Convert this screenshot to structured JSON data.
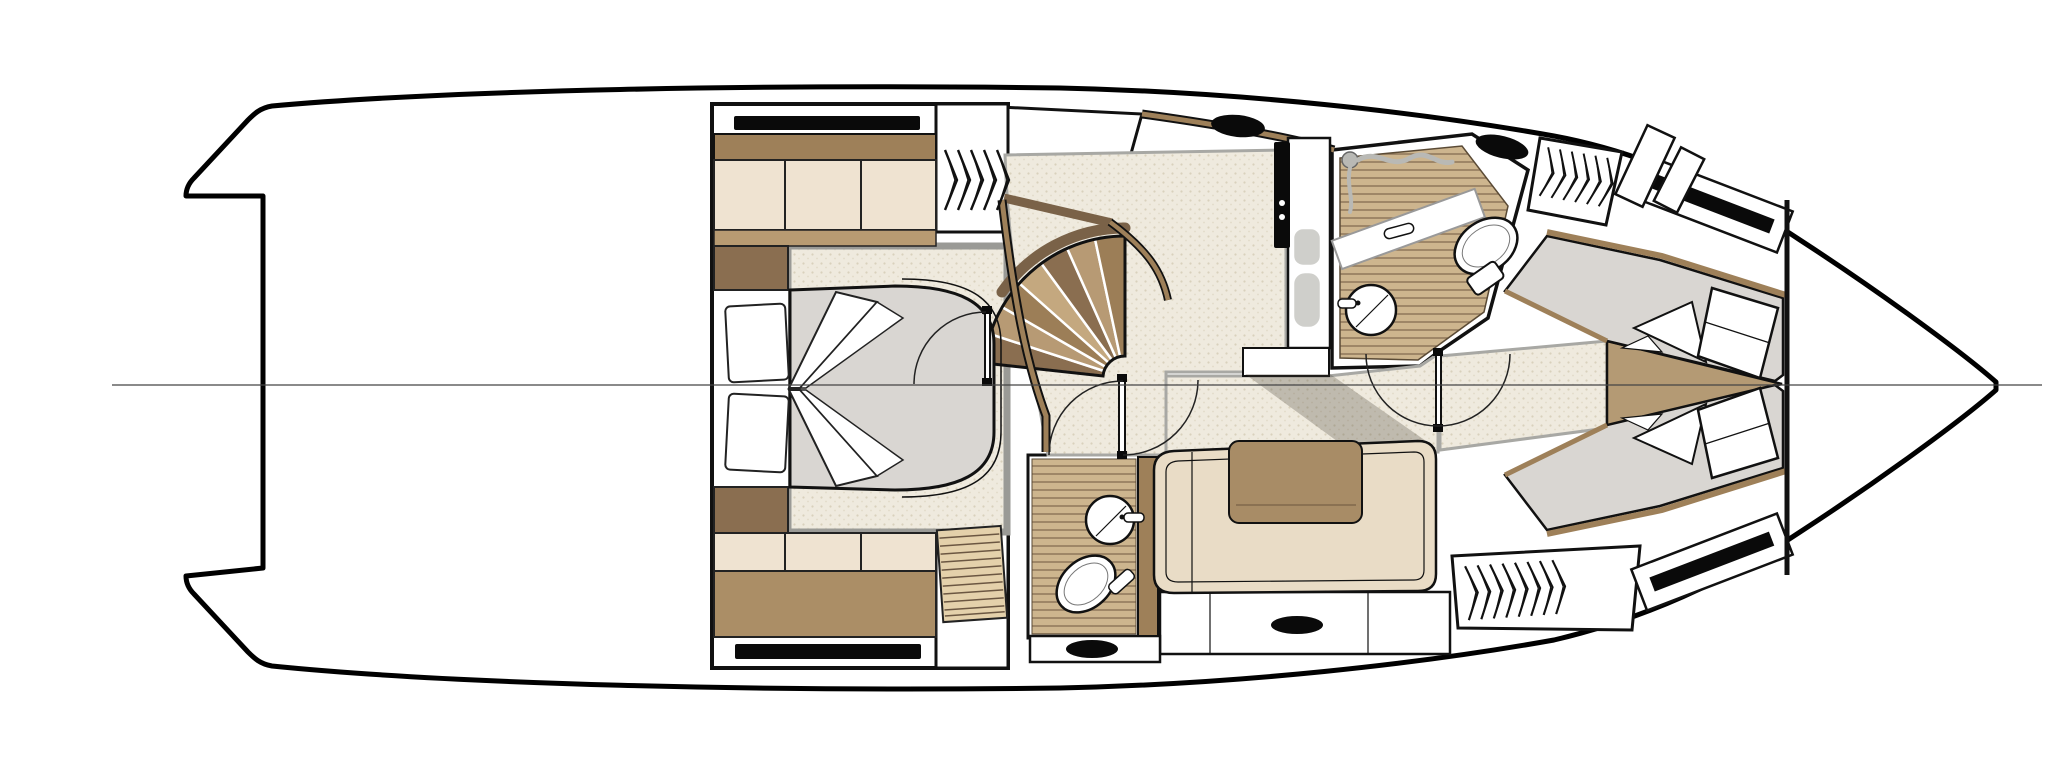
{
  "meta": {
    "type": "yacht-floorplan",
    "subject": "Motor yacht lower-deck accommodation plan, top-down technical line drawing",
    "orientation": "stern at left with swim-platform cutout, bow pointing right",
    "background": "#ffffff",
    "visible_text": ""
  },
  "colors": {
    "line": "#111111",
    "hull_line": "#000000",
    "white": "#ffffff",
    "wood": "#9e8059",
    "wood_dark": "#7a6248",
    "wood_deep": "#8a6e50",
    "cream": "#efe3d1",
    "tan": "#b89b72",
    "tan_mid": "#ab8e66",
    "tan_wedge": "#b49a74",
    "mattress": "#d9d6d2",
    "carpet": "#efeade",
    "carpet_dot": "#d9d1bc",
    "teak": "#cdb58e",
    "teak_line": "#8a7356",
    "slat_light": "#e4d1ab",
    "slat_line": "#6b5742",
    "gray_band": "#9a9a96",
    "gray_fixture": "#b9b9b5",
    "sink_gray": "#cfcfcb",
    "black_fixture": "#0a0a0a",
    "settee": "#e9dcc6",
    "cushion": "#a88c66",
    "stair_a": "#8a6e50",
    "stair_b": "#b79a74",
    "stair_c": "#9c7e57",
    "stair_d": "#c4a87f",
    "shadow": "rgba(70,62,50,0.28)",
    "centerline": "#444444"
  },
  "features": {
    "hull": {
      "shape": "planing motorhull with swim platform notch at stern",
      "centerline": true
    },
    "master_stateroom": {
      "location": "aft block",
      "bed_pillows": 2,
      "sheet_folds": 4,
      "tv_or_window_strips": 2,
      "cabinet_sections_top": 3,
      "cabinet_sections_bottom": 3,
      "nightstands": 2,
      "wardrobe_chevrons": 5,
      "entry_door_arcs": 1
    },
    "companionway_stairs": {
      "shape": "curved fan",
      "treads": 7,
      "landing": 1
    },
    "galley": {
      "cooktop_panel": "black",
      "burner_knobs": 2,
      "sinks": 2,
      "portlight_ovals": 1
    },
    "forward_head": {
      "toilet": 1,
      "round_sink": 1,
      "shower_hose": 1,
      "teak_floor": true,
      "portlight_ovals": 1,
      "vanity_band": 1,
      "wardrobe_chevrons": 6
    },
    "mid_head": {
      "toilet": 1,
      "round_sink": 1,
      "shower_grate_slats": 11,
      "teak_floor": true
    },
    "salon": {
      "settee": "L-shaped",
      "back_cushion": 1,
      "storage_front_ovals": 2
    },
    "forward_cabin": {
      "berth": "V-berth pair",
      "pillows": 2,
      "sheet_folds": 4,
      "hull_windows": 2,
      "wardrobe_chevrons": 8,
      "deck_hatches": 2,
      "center_wood_wedge": 1
    },
    "doors": {
      "leaves": 3,
      "swing_arcs": 5
    }
  }
}
